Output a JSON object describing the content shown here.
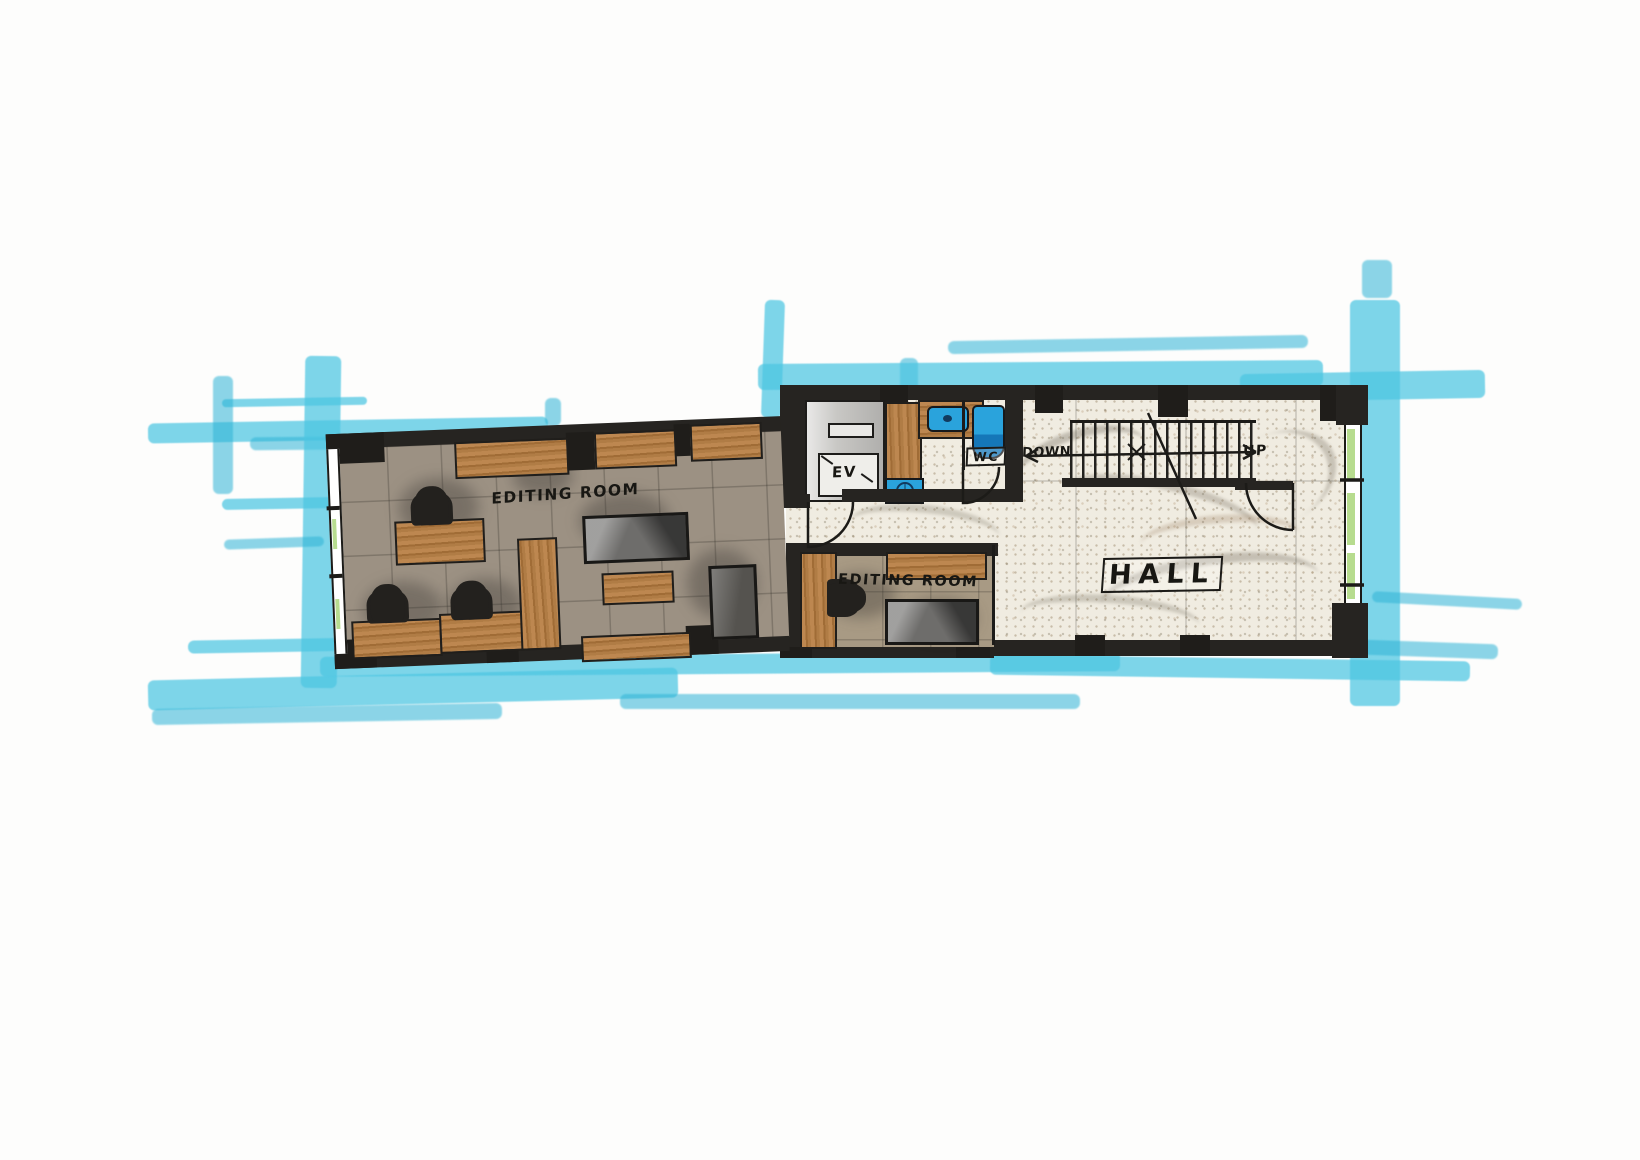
{
  "drawing": {
    "type": "hand-drawn floor plan marker sketch",
    "labels": {
      "editing_room_1": "EDITING ROOM",
      "editing_room_2": "EDITING ROOM",
      "elevator": "EV",
      "wc": "WC",
      "stairs_down": "DOWN",
      "stairs_up": "UP",
      "hall": "HALL"
    },
    "palette": {
      "marker_cyan": "#4cc6e2",
      "marker_cyan_dark": "#2fb4d6",
      "wall_ink": "#262421",
      "wood": "#b9834f",
      "wood_grain": "#7c4b20",
      "floor_editing_room_1": "#9c9183",
      "floor_editing_room_2": "#a89a84",
      "floor_hall": "#f0ece1",
      "fixture_blue": "#2aa3dc",
      "window_green": "#b7dc8f",
      "chair_black": "#23211e"
    }
  }
}
